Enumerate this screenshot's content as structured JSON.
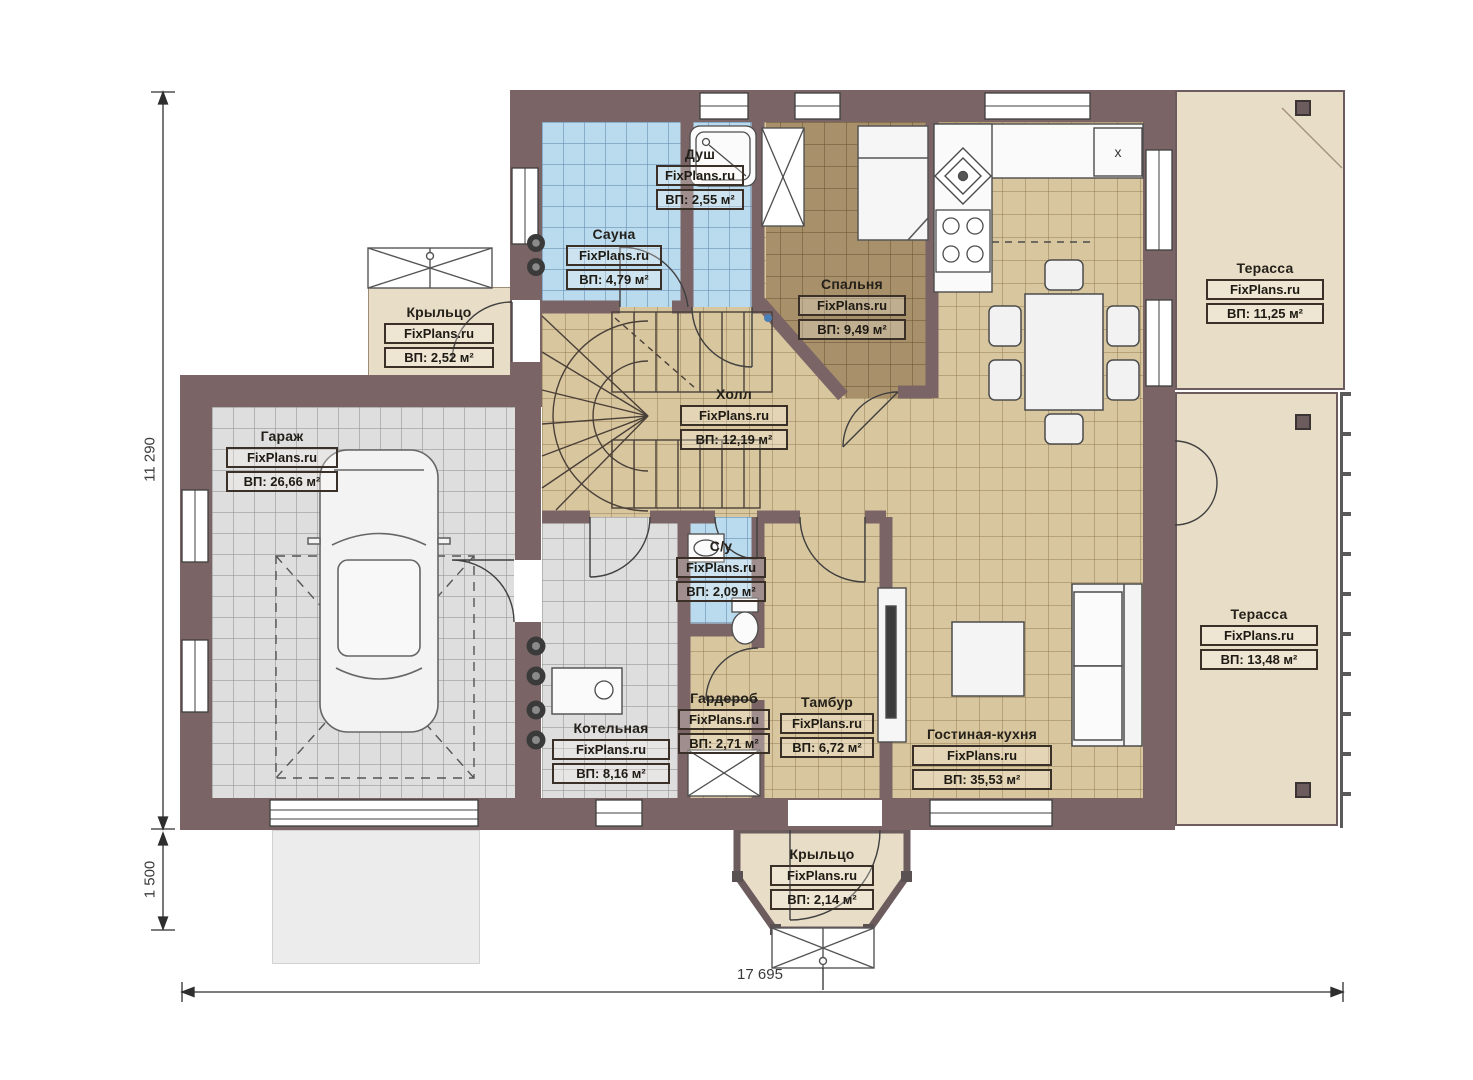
{
  "brand": "FixPlans.ru",
  "dimensions": {
    "left_main": "11 290",
    "left_porch": "1 500",
    "bottom_total": "17 695"
  },
  "kitchen": {
    "fridge_mark": "x"
  },
  "rooms": {
    "dush": {
      "name": "Душ",
      "area": "ВП: 2,55 м²"
    },
    "sauna": {
      "name": "Сауна",
      "area": "ВП: 4,79 м²"
    },
    "spalnya": {
      "name": "Спальня",
      "area": "ВП: 9,49 м²"
    },
    "terrasa_top": {
      "name": "Терасса",
      "area": "ВП: 11,25 м²"
    },
    "krylco_left": {
      "name": "Крыльцо",
      "area": "ВП: 2,52 м²"
    },
    "garazh": {
      "name": "Гараж",
      "area": "ВП: 26,66 м²"
    },
    "holl": {
      "name": "Холл",
      "area": "ВП: 12,19 м²"
    },
    "su": {
      "name": "С/у",
      "area": "ВП: 2,09 м²"
    },
    "terrasa_right": {
      "name": "Терасса",
      "area": "ВП: 13,48 м²"
    },
    "kotelnaya": {
      "name": "Котельная",
      "area": "ВП: 8,16 м²"
    },
    "garderob": {
      "name": "Гардероб",
      "area": "ВП: 2,71 м²"
    },
    "tambur": {
      "name": "Тамбур",
      "area": "ВП: 6,72 м²"
    },
    "gostinaya": {
      "name": "Гостиная-кухня",
      "area": "ВП: 35,53 м²"
    },
    "krylco_bottom": {
      "name": "Крыльцо",
      "area": "ВП: 2,14 м²"
    }
  }
}
